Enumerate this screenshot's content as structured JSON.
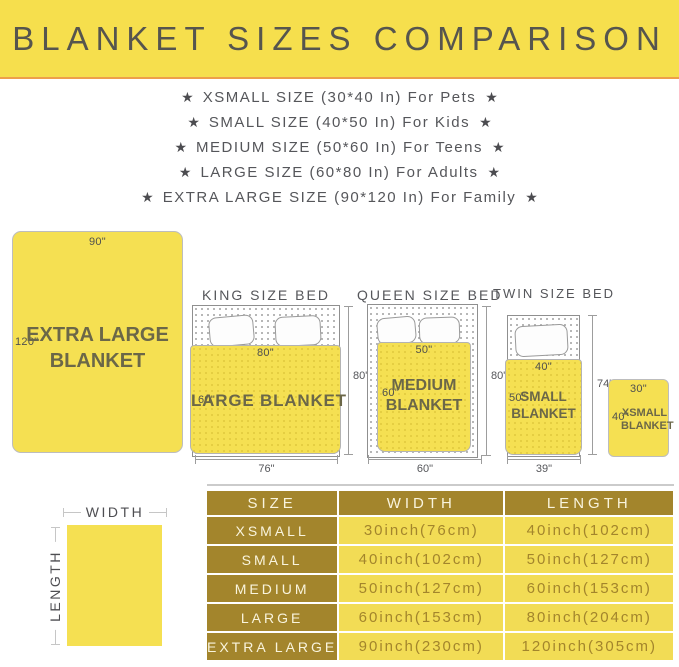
{
  "header": {
    "title": "BLANKET SIZES COMPARISON"
  },
  "star_glyph": "★",
  "size_list": [
    "XSMALL SIZE (30*40 In) For Pets",
    "SMALL SIZE (40*50 In) For Kids",
    "MEDIUM SIZE (50*60 In) For Teens",
    "LARGE SIZE (60*80 In) For Adults",
    "EXTRA LARGE SIZE (90*120 In) For Family"
  ],
  "diagram": {
    "xl": {
      "top": "90\"",
      "side": "120\"",
      "line1": "EXTRA LARGE",
      "line2": "BLANKET"
    },
    "king": {
      "title": "KING SIZE BED",
      "top": "80\"",
      "side": "60\"",
      "name": "LARGE BLANKET",
      "height": "80\"",
      "width": "76\""
    },
    "queen": {
      "title": "QUEEN SIZE BED",
      "top": "50\"",
      "side": "60\"",
      "line1": "MEDIUM",
      "line2": "BLANKET",
      "height": "80\"",
      "width": "60\""
    },
    "twin": {
      "title": "TWIN SIZE BED",
      "top": "40\"",
      "side": "50\"",
      "line1": "SMALL",
      "line2": "BLANKET",
      "height": "74\"",
      "width": "39\""
    },
    "xs": {
      "top": "30\"",
      "side": "40\"",
      "line1": "XSMALL",
      "line2": "BLANKET"
    }
  },
  "legend": {
    "width": "WIDTH",
    "length": "LENGTH"
  },
  "table": {
    "headers": [
      "SIZE",
      "WIDTH",
      "LENGTH"
    ],
    "rows": [
      [
        "XSMALL",
        "30inch(76cm)",
        "40inch(102cm)"
      ],
      [
        "SMALL",
        "40inch(102cm)",
        "50inch(127cm)"
      ],
      [
        "MEDIUM",
        "50inch(127cm)",
        "60inch(153cm)"
      ],
      [
        "LARGE",
        "60inch(153cm)",
        "80inch(204cm)"
      ],
      [
        "EXTRA LARGE",
        "90inch(230cm)",
        "120inch(305cm)"
      ]
    ]
  },
  "colors": {
    "banner_yellow": "#f6df4d",
    "accent_orange": "#ee9f4a",
    "blanket_yellow": "#f5e052",
    "table_gold": "#a3852c",
    "table_cell_yellow": "#f2dc55",
    "heading_gray": "#55565a",
    "blanket_text": "#6b6748"
  }
}
